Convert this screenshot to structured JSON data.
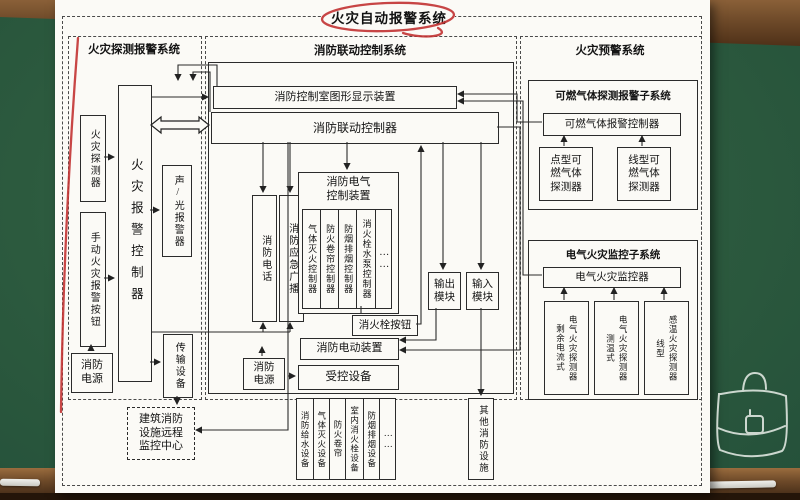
{
  "title": "火灾自动报警系统",
  "colors": {
    "board": "#2c5a3e",
    "wood": "#6e4a29",
    "paper": "#fbfaf6",
    "annotation_red": "#c23232",
    "line": "#2b2b2b",
    "chalk": "#e8e8e4"
  },
  "left": {
    "header": "火灾探测报警系统",
    "fire_detector": "火灾探测器",
    "manual_button": "手动火灾报警按钮",
    "power": "消防电源",
    "controller": "火灾报警控制器",
    "sound_light": "声/光报警器",
    "transmission": "传输设备",
    "remote_center": "建筑消防设施远程监控中心"
  },
  "middle": {
    "header": "消防联动控制系统",
    "display": "消防控制室图形显示装置",
    "controller": "消防联动控制器",
    "phone": "消防电话",
    "broadcast": "消防应急广播",
    "electric_group": "消防电气控制装置",
    "gas_controller": "气体灭火控制器",
    "shutter_controller": "防火卷帘控制器",
    "smoke_controller": "防烟排烟控制器",
    "pump_controller": "消火栓水泵控制器",
    "dots": "……",
    "output_module": "输出模块",
    "input_module": "输入模块",
    "hydrant_button": "消火栓按钮",
    "electric_device": "消防电动装置",
    "controlled": "受控设备",
    "power": "消防电源",
    "equipment": [
      "消防给水设备",
      "气体灭火设备",
      "防火卷帘",
      "室内消火栓设备",
      "防烟排烟设备"
    ],
    "equipment_dots": "……",
    "other": "其他消防设施"
  },
  "right": {
    "header": "火灾预警系统",
    "gas_subsystem": "可燃气体探测报警子系统",
    "gas_controller": "可燃气体报警控制器",
    "point_detector": "点型可燃气体探测器",
    "line_detector": "线型可燃气体探测器",
    "electric_subsystem": "电气火灾监控子系统",
    "electric_monitor": "电气火灾监控器",
    "detectors": [
      {
        "type": "剩余电流式",
        "name": "电气火灾探测器"
      },
      {
        "type": "测温式",
        "name": "电气火灾探测器"
      },
      {
        "type": "线型",
        "name": "感温火灾探测器"
      }
    ]
  }
}
